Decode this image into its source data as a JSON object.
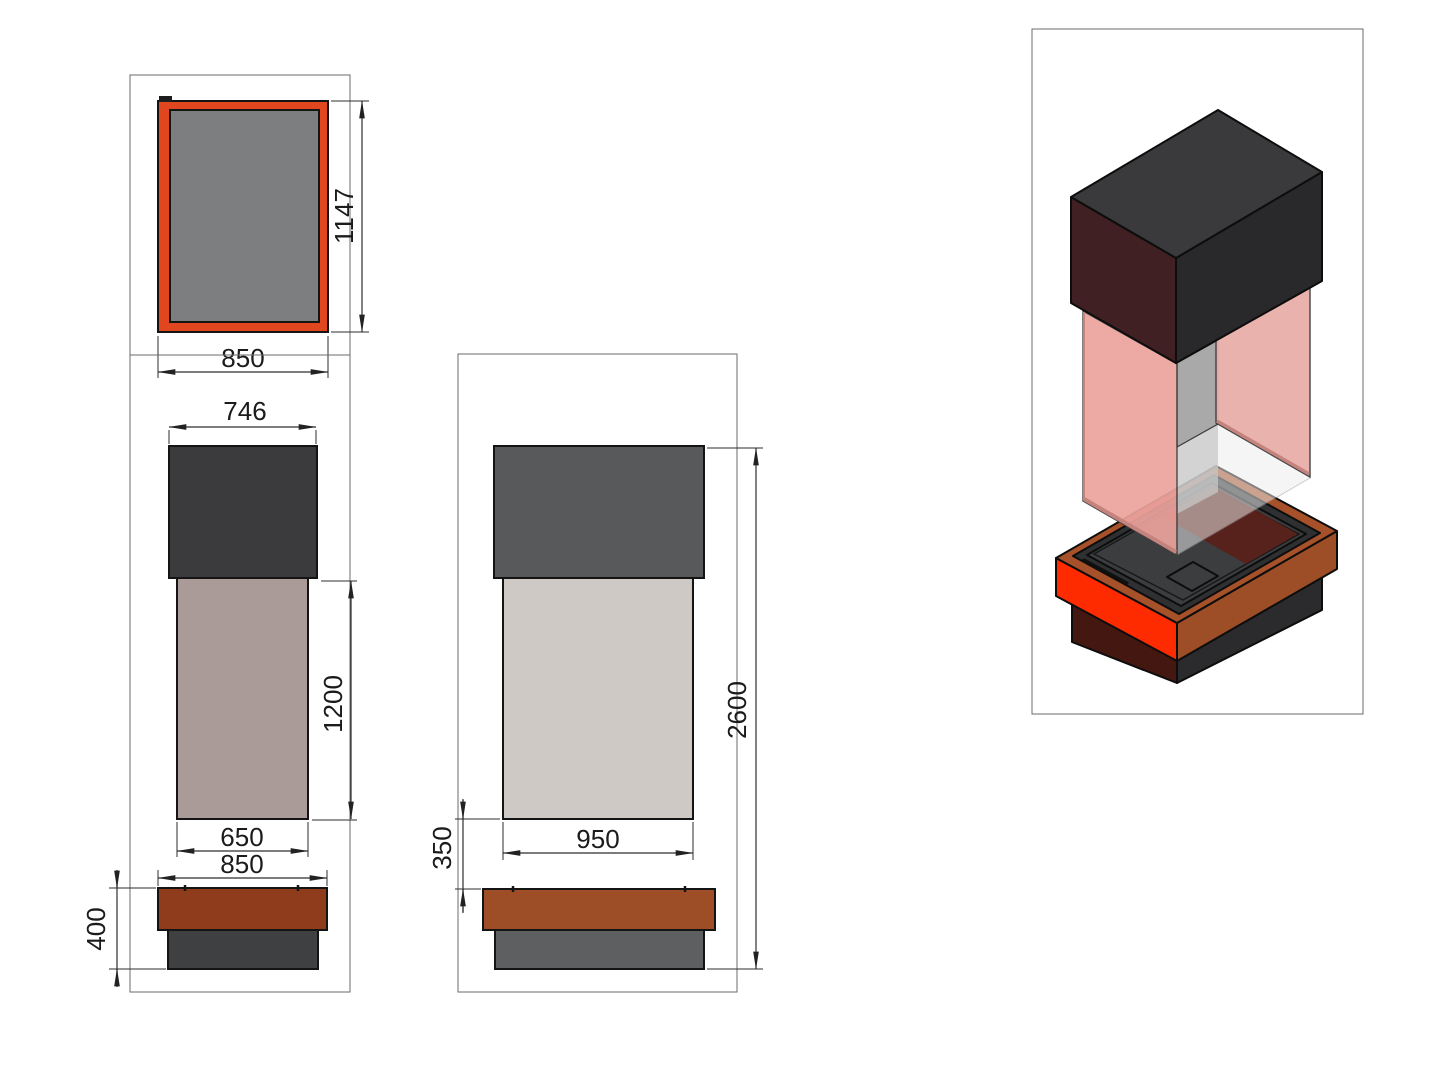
{
  "title": "fireplace-column-technical-drawing",
  "views": {
    "plan": {
      "dim_width": "850",
      "dim_height": "1147"
    },
    "front": {
      "dim_hood_width": "746",
      "dim_column_height": "1200",
      "dim_firebox_width": "650",
      "dim_base_width": "850",
      "dim_base_height": "400"
    },
    "side": {
      "dim_gap_height": "350",
      "dim_firebox_width": "950",
      "dim_overall_height": "2600"
    }
  },
  "colors": {
    "orange_rim": "#E0471E",
    "plan_glass": "#7D7E80",
    "hood_front": "#3B3B3D",
    "hood_side": "#58595B",
    "column_front": "#AB9B98",
    "column_side": "#CEC9C5",
    "base_rust_front": "#8E3C1C",
    "base_rust_side": "#9E4E26",
    "base_dark_front": "#3F4041",
    "base_gray_side": "#5E5F61",
    "iso_hood_top": "#3A3A3C",
    "iso_hood_left": "#402022",
    "iso_hood_right": "#29292B",
    "glass_pink": "#ECA39E",
    "glass_pink_back": "#EAAFAA",
    "inner_gray": "#A9A9A9",
    "red_bright": "#FF2B00",
    "maroon_dark": "#451711",
    "base_charcoal": "#2B2B2D",
    "tray_rim": "#A65129",
    "tray_dark": "#2E3032",
    "tray_floor": "#3B3D3F",
    "tray_maroon": "#5C1F18"
  }
}
